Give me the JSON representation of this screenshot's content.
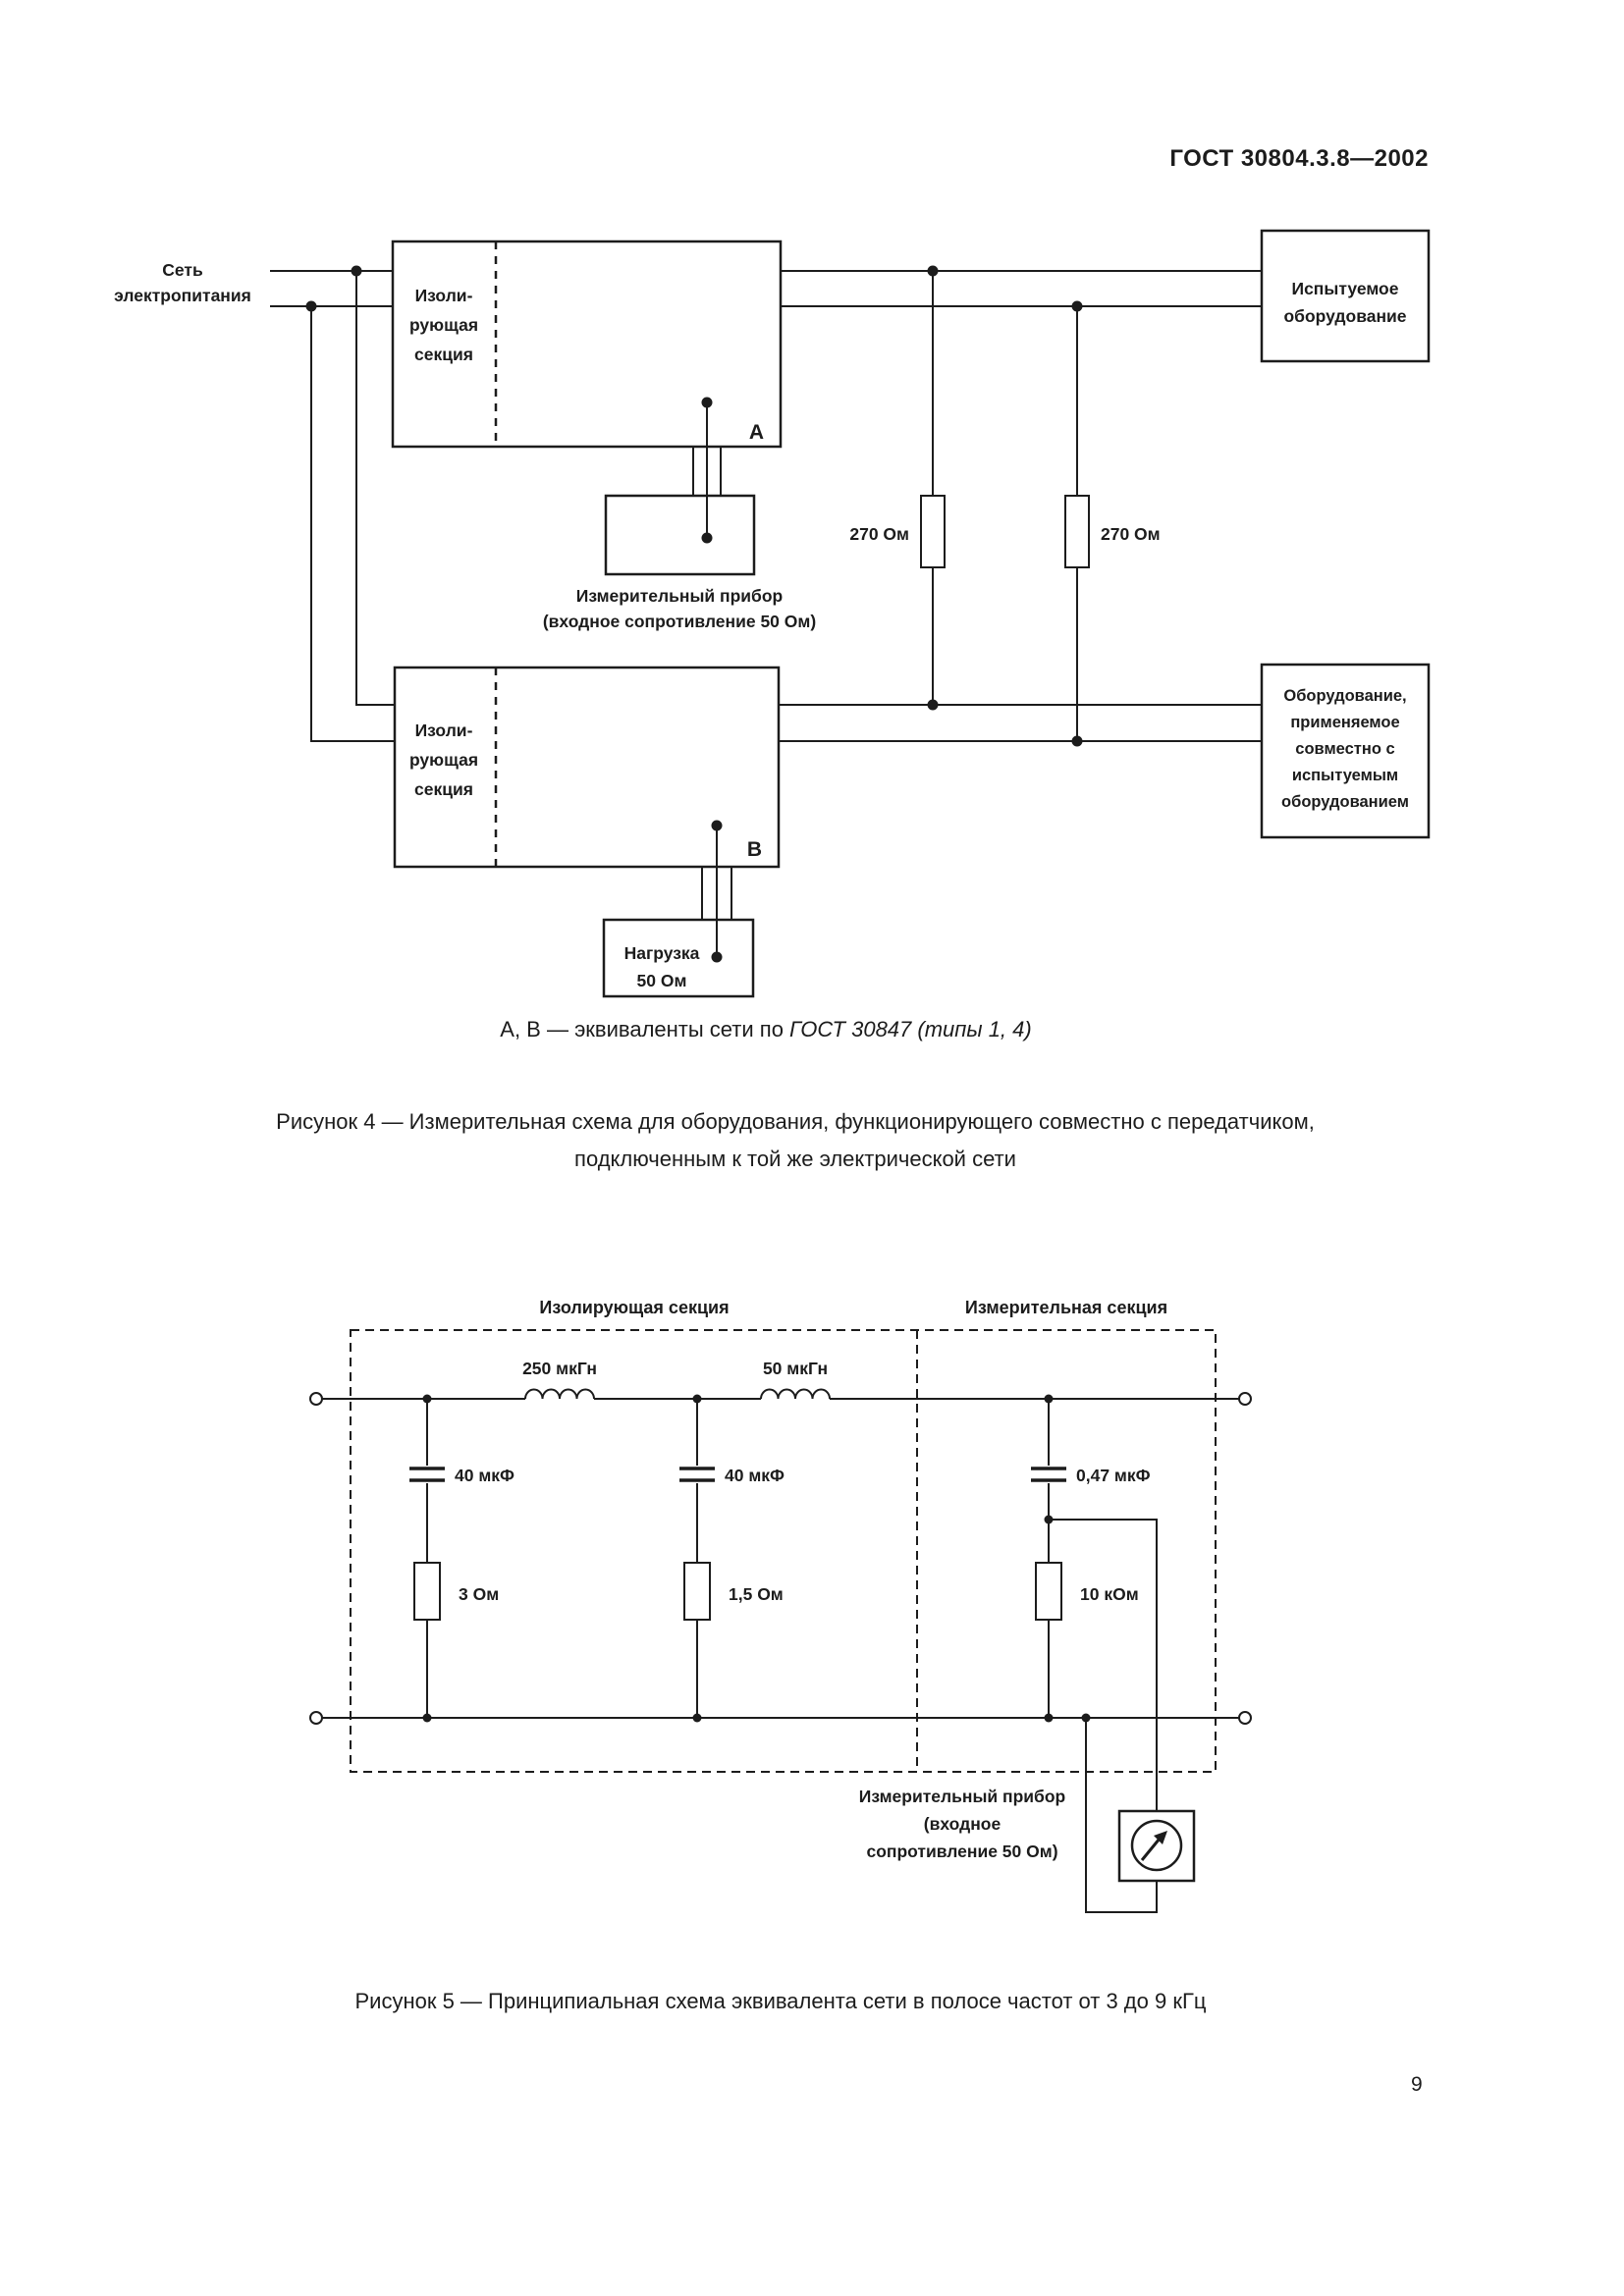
{
  "page": {
    "header": "ГОСТ 30804.3.8—2002",
    "number": "9"
  },
  "colors": {
    "ink": "#1c1c1c",
    "paper": "#ffffff"
  },
  "figure4": {
    "mains": [
      "Сеть",
      "электропитания"
    ],
    "isolating_a": [
      "Изоли-",
      "рующая",
      "секция"
    ],
    "isolating_b": [
      "Изоли-",
      "рующая",
      "секция"
    ],
    "terminal_a": "А",
    "terminal_b": "В",
    "eut": [
      "Испытуемое",
      "оборудование"
    ],
    "resistor_left": "270 Ом",
    "resistor_right": "270 Ом",
    "meter": [
      "Измерительный прибор",
      "(входное сопротивление 50 Ом)"
    ],
    "aux_equipment": [
      "Оборудование,",
      "применяемое",
      "совместно с",
      "испытуемым",
      "оборудованием"
    ],
    "load": [
      "Нагрузка",
      "50 Ом"
    ],
    "note_text": "А, В — эквиваленты сети по ",
    "note_italic": "ГОСТ 30847 (типы 1, 4)",
    "caption": [
      "Рисунок 4 — Измерительная схема для оборудования, функционирующего совместно с передатчиком,",
      "подключенным к той же электрической сети"
    ]
  },
  "figure5": {
    "sections": [
      "Изолирующая секция",
      "Измерительная секция"
    ],
    "inductors": [
      "250 мкГн",
      "50 мкГн"
    ],
    "capacitors": [
      "40 мкФ",
      "40 мкФ",
      "0,47 мкФ"
    ],
    "resistors": [
      "3 Ом",
      "1,5 Ом",
      "10 кОм"
    ],
    "meter": [
      "Измерительный прибор",
      "(входное",
      "сопротивление 50 Ом)"
    ],
    "caption": "Рисунок 5 — Принципиальная схема эквивалента сети в полосе частот от 3 до 9 кГц"
  }
}
